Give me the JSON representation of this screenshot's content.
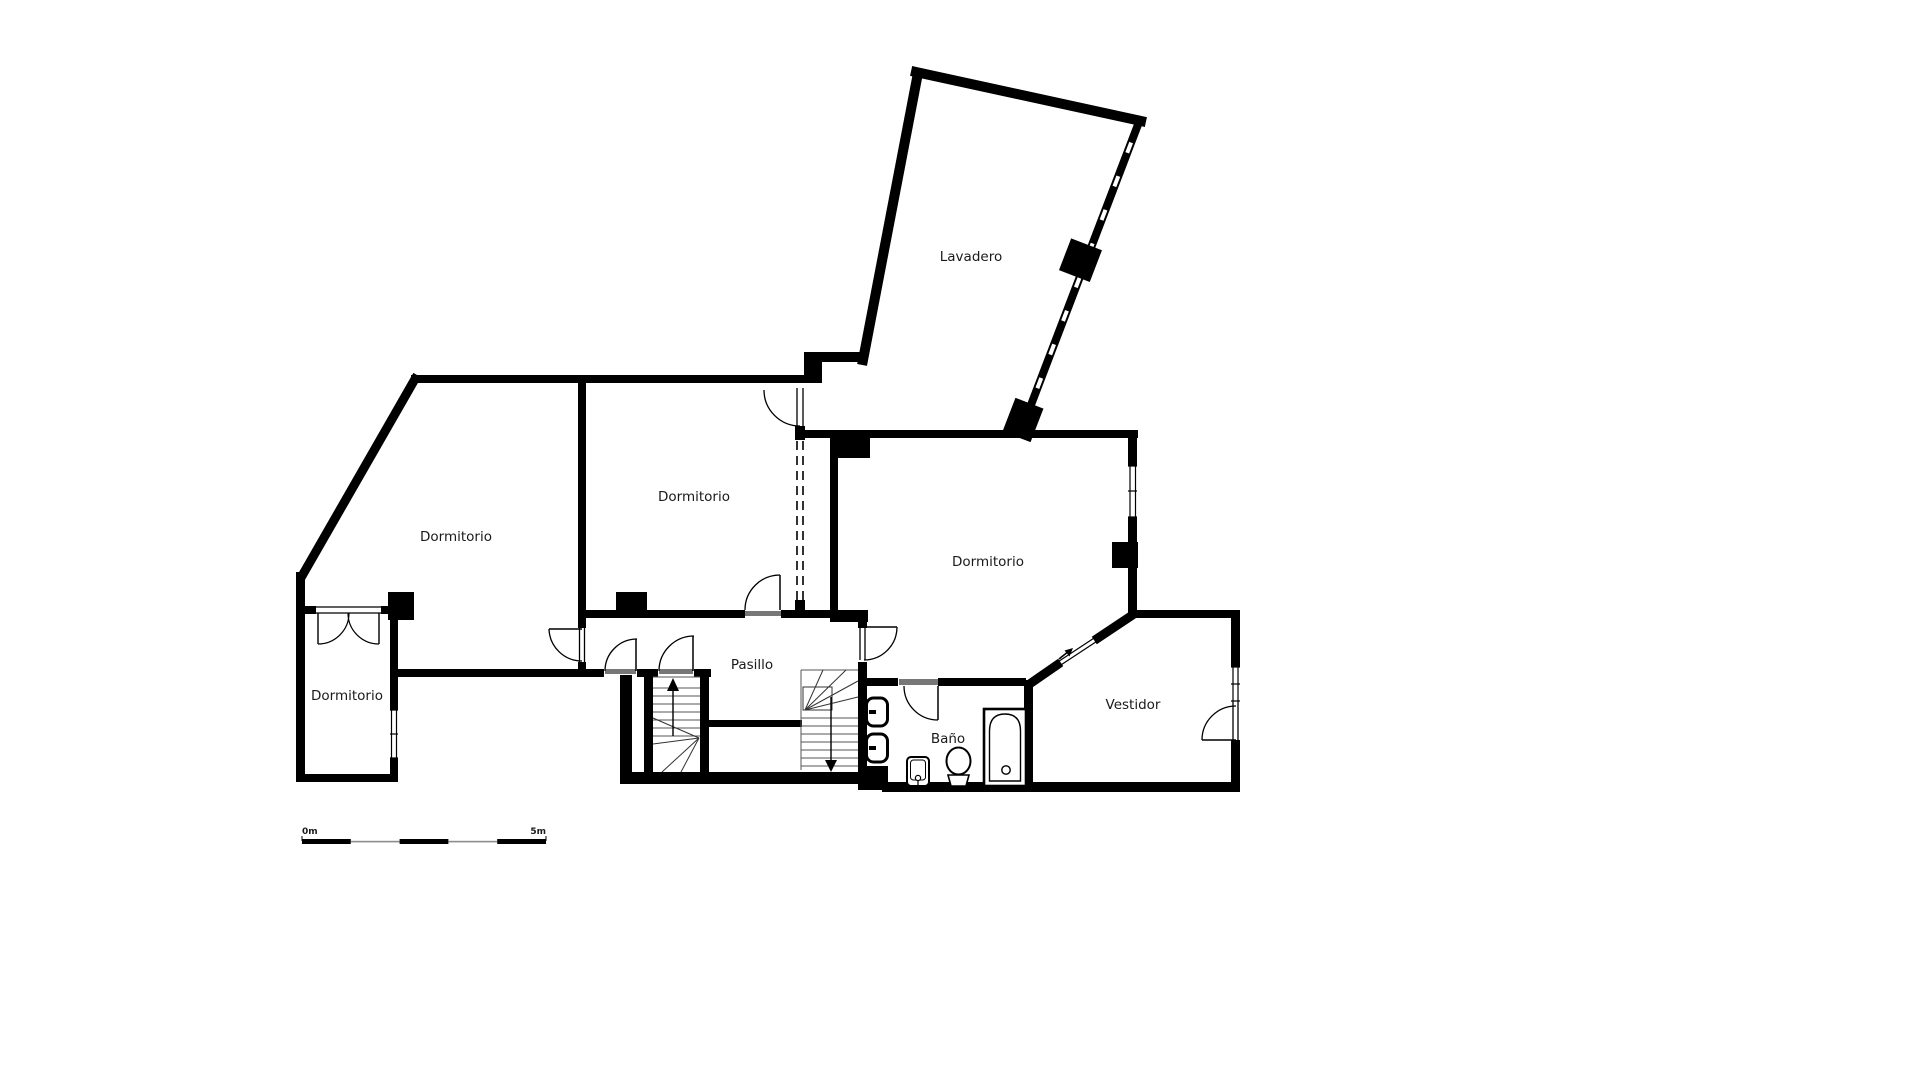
{
  "plan_title": "Floor plan",
  "rooms": [
    {
      "id": "lavadero",
      "label": "Lavadero"
    },
    {
      "id": "dormitorio-left",
      "label": "Dormitorio"
    },
    {
      "id": "dormitorio-center",
      "label": "Dormitorio"
    },
    {
      "id": "dormitorio-right",
      "label": "Dormitorio"
    },
    {
      "id": "dormitorio-small",
      "label": "Dormitorio"
    },
    {
      "id": "pasillo",
      "label": "Pasillo"
    },
    {
      "id": "bano",
      "label": "Baño"
    },
    {
      "id": "vestidor",
      "label": "Vestidor"
    }
  ],
  "scale_bar": {
    "start_label": "0m",
    "end_label": "5m",
    "segments": 5,
    "meters": 5
  },
  "stairs": [
    {
      "id": "stair-up",
      "direction": "up"
    },
    {
      "id": "stair-down",
      "direction": "down"
    }
  ],
  "entry_arrow": {
    "symbol": "↗",
    "meaning": "entrance-direction"
  },
  "fixtures": [
    "radiator",
    "radiator",
    "sink",
    "toilet",
    "bathtub"
  ],
  "colors": {
    "wall": "#000000",
    "text": "#1a1a1a",
    "threshold_gray": "#777777",
    "scale_gray": "#8c8c8c",
    "background": "#ffffff"
  }
}
